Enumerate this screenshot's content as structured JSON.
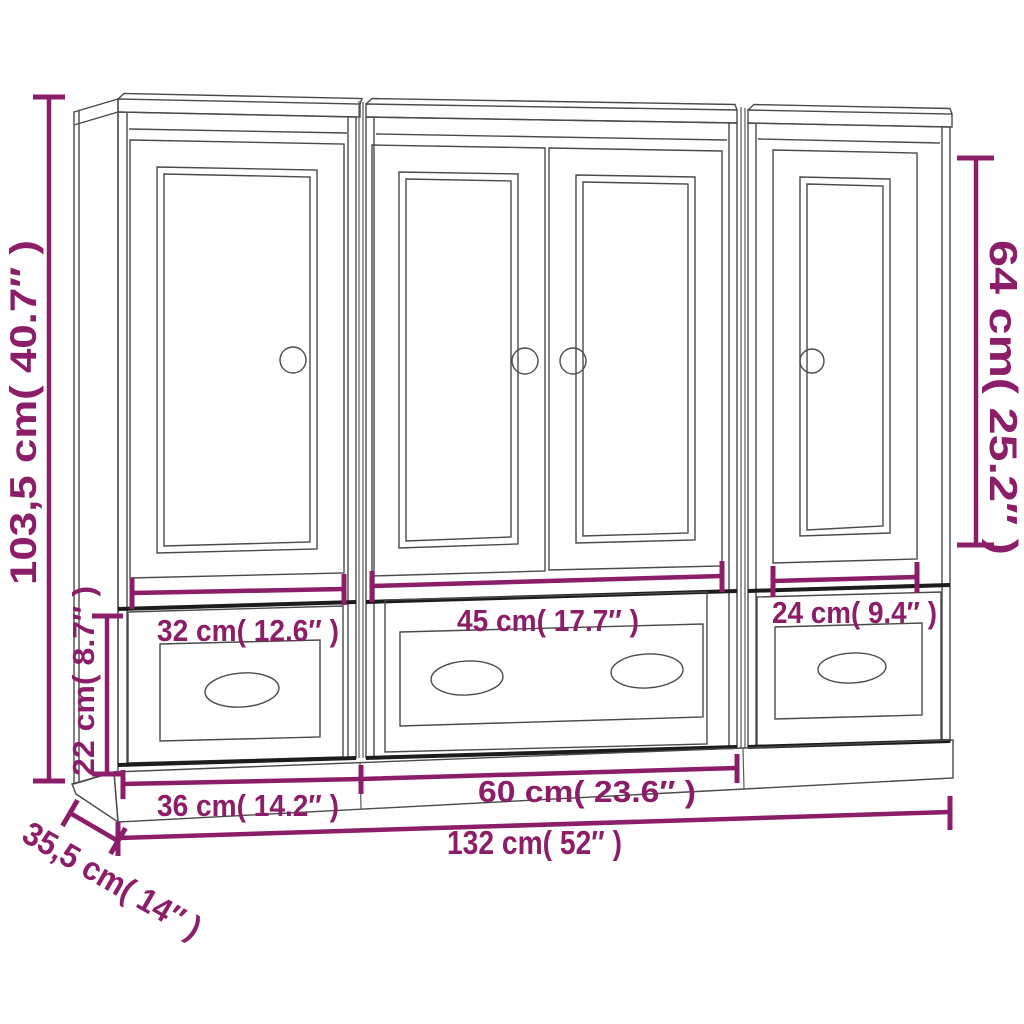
{
  "diagram": {
    "type": "furniture-dimension-diagram",
    "units_shown": 3,
    "colors": {
      "accent": "#8c1d68",
      "line": "#4a4a4a",
      "background": "#ffffff"
    },
    "dimensions": {
      "total_height": "103,5 cm( 40.7″ )",
      "base_height": "22 cm( 8.7″ )",
      "door_height": "64 cm( 25.2″ )",
      "left_opening_width": "32 cm( 12.6″ )",
      "center_opening_width": "45 cm( 17.7″ )",
      "right_opening_width": "24 cm( 9.4″ )",
      "side_unit_width": "36 cm( 14.2″ )",
      "center_unit_width": "60 cm( 23.6″ )",
      "total_width": "132 cm( 52″ )",
      "depth": "35,5 cm( 14″ )"
    }
  }
}
